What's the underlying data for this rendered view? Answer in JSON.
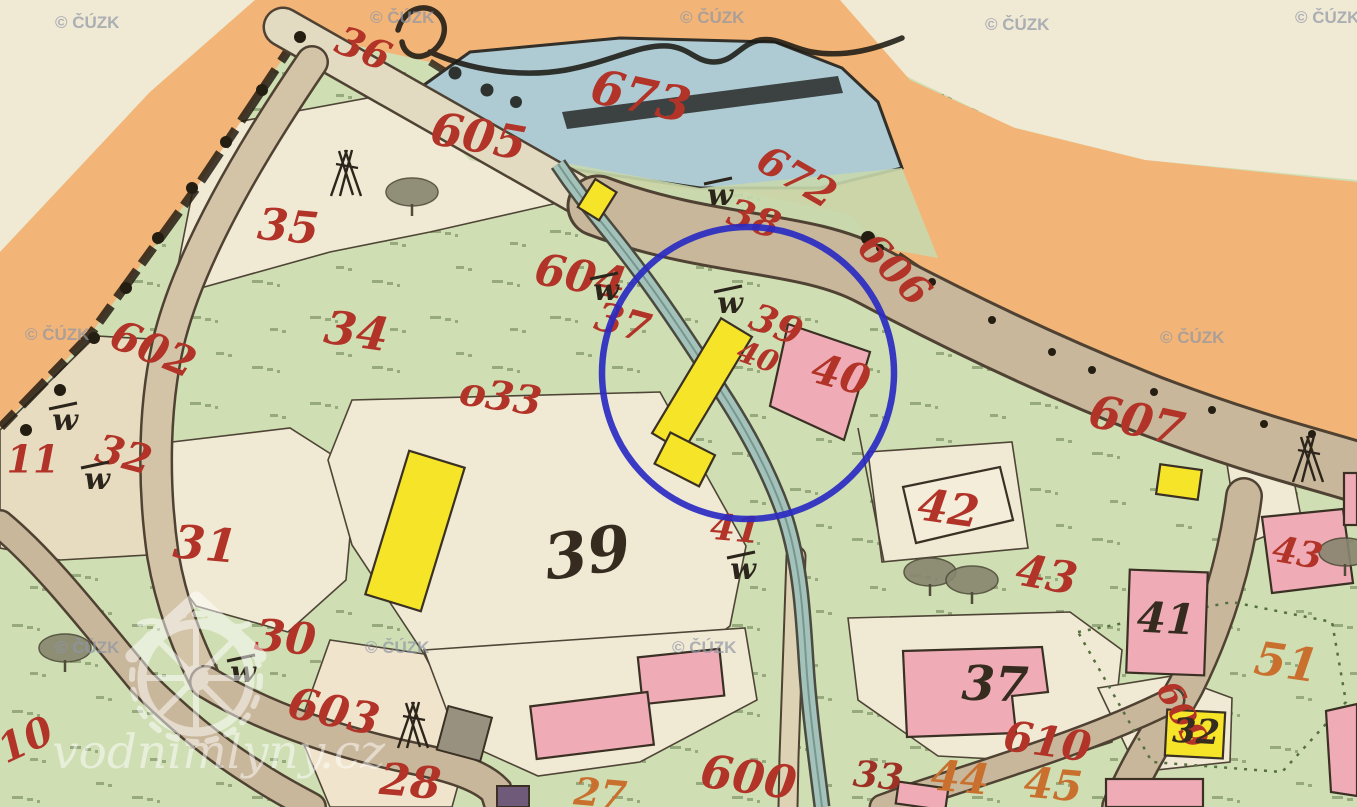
{
  "source": {
    "watermark_text": "© ČÚZK",
    "site_watermark_text": "vodnimlyny.cz"
  },
  "map": {
    "type": "historical-cadastral-map",
    "colors": {
      "label_red": "#b23327",
      "label_orange": "#c9702e",
      "label_black": "#352c1f",
      "label_darkred": "#9e3125",
      "highlight_blue": "#2a2ac2",
      "water_blue": "#aecbd4",
      "meadow_green": "#cfdeb3",
      "road_tan": "#c9b79b",
      "orange_band": "#f3b577",
      "building_wood_yellow": "#f6e428",
      "building_masonry_pink": "#efacb6",
      "paper_cream": "#efe8d2"
    },
    "highlight_circle": {
      "cx": 748,
      "cy": 373,
      "r": 146
    },
    "parcel_labels": [
      {
        "text": "36",
        "x": 362,
        "y": 52,
        "size": 40,
        "rot": 22,
        "color": "red",
        "kind": "parcel"
      },
      {
        "text": "605",
        "x": 478,
        "y": 140,
        "size": 46,
        "rot": 10,
        "color": "red",
        "kind": "road"
      },
      {
        "text": "673",
        "x": 640,
        "y": 100,
        "size": 48,
        "rot": 12,
        "color": "red",
        "kind": "water"
      },
      {
        "text": "672",
        "x": 795,
        "y": 180,
        "size": 40,
        "rot": 30,
        "color": "red",
        "kind": "parcel"
      },
      {
        "text": "606",
        "x": 892,
        "y": 272,
        "size": 40,
        "rot": 45,
        "color": "red",
        "kind": "road"
      },
      {
        "text": "38",
        "x": 753,
        "y": 222,
        "size": 38,
        "rot": 18,
        "color": "red",
        "kind": "parcel"
      },
      {
        "text": "604",
        "x": 580,
        "y": 280,
        "size": 44,
        "rot": 10,
        "color": "red",
        "kind": "road"
      },
      {
        "text": "37",
        "x": 622,
        "y": 326,
        "size": 40,
        "rot": 15,
        "color": "red",
        "kind": "parcel"
      },
      {
        "text": "39",
        "x": 775,
        "y": 328,
        "size": 38,
        "rot": 22,
        "color": "red",
        "kind": "parcel"
      },
      {
        "text": "40",
        "x": 757,
        "y": 359,
        "size": 30,
        "rot": 20,
        "color": "red",
        "kind": "parcel"
      },
      {
        "text": "40",
        "x": 840,
        "y": 378,
        "size": 42,
        "rot": 15,
        "color": "red",
        "kind": "parcel"
      },
      {
        "text": "35",
        "x": 288,
        "y": 230,
        "size": 44,
        "rot": 5,
        "color": "red",
        "kind": "parcel"
      },
      {
        "text": "602",
        "x": 152,
        "y": 352,
        "size": 42,
        "rot": 22,
        "color": "red",
        "kind": "road"
      },
      {
        "text": "34",
        "x": 356,
        "y": 335,
        "size": 46,
        "rot": 8,
        "color": "red",
        "kind": "parcel"
      },
      {
        "text": "32",
        "x": 123,
        "y": 458,
        "size": 40,
        "rot": 15,
        "color": "red",
        "kind": "parcel"
      },
      {
        "text": "11",
        "x": 33,
        "y": 463,
        "size": 38,
        "rot": 0,
        "color": "red",
        "kind": "parcel"
      },
      {
        "text": "o33",
        "x": 500,
        "y": 400,
        "size": 40,
        "rot": 8,
        "color": "red",
        "kind": "parcel"
      },
      {
        "text": "31",
        "x": 205,
        "y": 548,
        "size": 46,
        "rot": 5,
        "color": "red",
        "kind": "parcel"
      },
      {
        "text": "41",
        "x": 735,
        "y": 532,
        "size": 36,
        "rot": 5,
        "color": "red",
        "kind": "parcel"
      },
      {
        "text": "42",
        "x": 948,
        "y": 512,
        "size": 44,
        "rot": 8,
        "color": "red",
        "kind": "parcel"
      },
      {
        "text": "607",
        "x": 1136,
        "y": 424,
        "size": 46,
        "rot": 12,
        "color": "red",
        "kind": "road"
      },
      {
        "text": "43",
        "x": 1046,
        "y": 578,
        "size": 44,
        "rot": 10,
        "color": "red",
        "kind": "parcel"
      },
      {
        "text": "43",
        "x": 1297,
        "y": 556,
        "size": 36,
        "rot": 10,
        "color": "red",
        "kind": "parcel"
      },
      {
        "text": "30",
        "x": 285,
        "y": 641,
        "size": 44,
        "rot": 5,
        "color": "red",
        "kind": "parcel"
      },
      {
        "text": "603",
        "x": 333,
        "y": 715,
        "size": 44,
        "rot": 12,
        "color": "red",
        "kind": "road"
      },
      {
        "text": "10",
        "x": 27,
        "y": 743,
        "size": 40,
        "rot": -25,
        "color": "red",
        "kind": "parcel"
      },
      {
        "text": "28",
        "x": 410,
        "y": 785,
        "size": 44,
        "rot": 5,
        "color": "red",
        "kind": "parcel"
      },
      {
        "text": "27",
        "x": 600,
        "y": 797,
        "size": 38,
        "rot": 5,
        "color": "orange",
        "kind": "parcel"
      },
      {
        "text": "600",
        "x": 748,
        "y": 781,
        "size": 46,
        "rot": 8,
        "color": "red",
        "kind": "road"
      },
      {
        "text": "610",
        "x": 1047,
        "y": 745,
        "size": 42,
        "rot": 8,
        "color": "red",
        "kind": "road"
      },
      {
        "text": "609",
        "x": 1180,
        "y": 716,
        "size": 34,
        "rot": 62,
        "color": "red",
        "kind": "road"
      },
      {
        "text": "44",
        "x": 960,
        "y": 781,
        "size": 42,
        "rot": 5,
        "color": "orange",
        "kind": "parcel"
      },
      {
        "text": "45",
        "x": 1053,
        "y": 788,
        "size": 42,
        "rot": 5,
        "color": "orange",
        "kind": "parcel"
      },
      {
        "text": "51",
        "x": 1286,
        "y": 666,
        "size": 46,
        "rot": 8,
        "color": "orange",
        "kind": "parcel"
      },
      {
        "text": "33",
        "x": 878,
        "y": 779,
        "size": 36,
        "rot": 5,
        "color": "darkred",
        "kind": "parcel"
      },
      {
        "text": "39",
        "x": 588,
        "y": 558,
        "size": 62,
        "rot": -8,
        "color": "black",
        "kind": "house"
      },
      {
        "text": "41",
        "x": 1166,
        "y": 622,
        "size": 42,
        "rot": 3,
        "color": "black",
        "kind": "house"
      },
      {
        "text": "37",
        "x": 995,
        "y": 688,
        "size": 48,
        "rot": 2,
        "color": "black",
        "kind": "house"
      },
      {
        "text": "32",
        "x": 1196,
        "y": 734,
        "size": 34,
        "rot": 3,
        "color": "black",
        "kind": "house"
      }
    ],
    "w_symbols": [
      [
        720,
        197
      ],
      [
        606,
        292
      ],
      [
        730,
        305
      ],
      [
        743,
        571
      ],
      [
        243,
        674
      ],
      [
        65,
        422
      ],
      [
        97,
        481
      ]
    ],
    "teepee_symbols": [
      [
        346,
        178
      ],
      [
        413,
        730
      ],
      [
        1308,
        464
      ]
    ],
    "tree_symbols": [
      [
        412,
        192
      ],
      [
        65,
        648
      ],
      [
        930,
        572
      ],
      [
        972,
        580
      ],
      [
        1345,
        552
      ]
    ],
    "cuzk_watermarks": [
      [
        55,
        20
      ],
      [
        370,
        15
      ],
      [
        680,
        15
      ],
      [
        985,
        22
      ],
      [
        1295,
        15
      ],
      [
        25,
        332
      ],
      [
        1160,
        335
      ],
      [
        55,
        645
      ],
      [
        365,
        645
      ],
      [
        672,
        645
      ]
    ]
  }
}
